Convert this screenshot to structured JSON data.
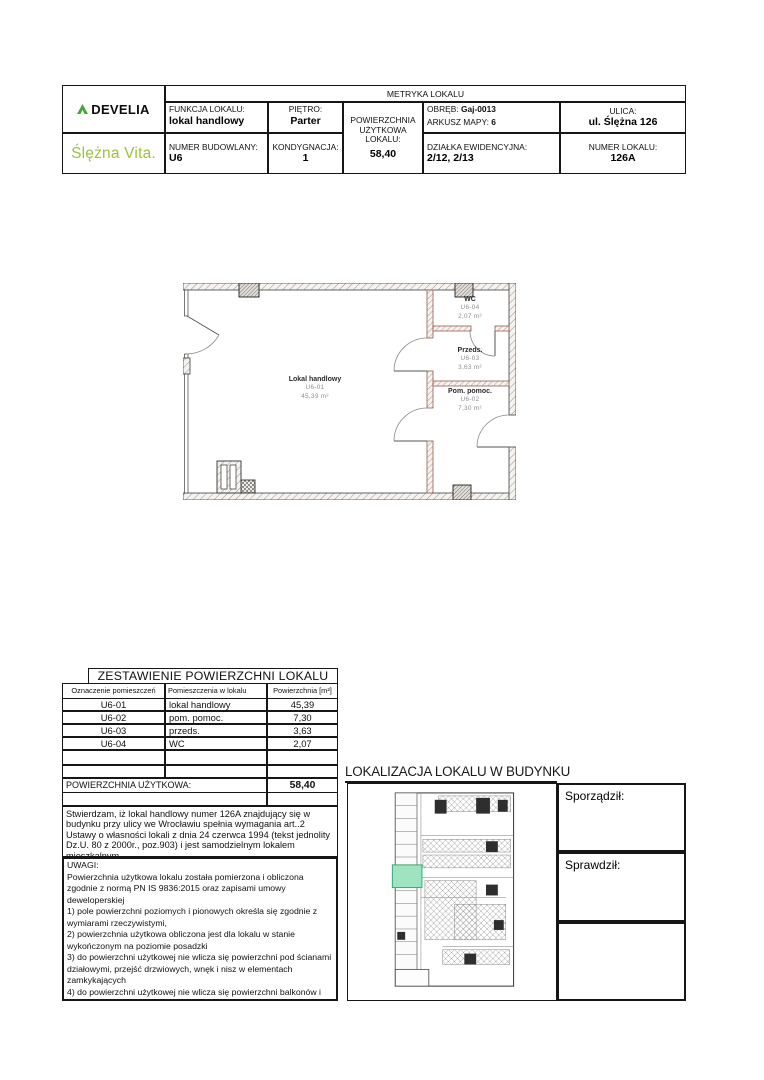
{
  "header": {
    "title": "METRYKA LOKALU",
    "brand_top": "DEVELIA",
    "brand_bottom": "Ślężna Vita.",
    "brand_green": "#9cc23c",
    "funkcja_label": "FUNKCJA LOKALU:",
    "funkcja_value": "lokal handlowy",
    "pietro_label": "PIĘTRO:",
    "pietro_value": "Parter",
    "powierzchnia_label": "POWIERZCHNIA UŻYTKOWA LOKALU:",
    "powierzchnia_value": "58,40",
    "obreb_label": "OBRĘB:",
    "obreb_value": "Gaj-0013",
    "arkusz_label": "ARKUSZ MAPY:",
    "arkusz_value": "6",
    "ulica_label": "ULICA:",
    "ulica_value": "ul. Ślężna 126",
    "numer_budowlany_label": "NUMER BUDOWLANY:",
    "numer_budowlany_value": "U6",
    "kondygnacja_label": "KONDYGNACJA:",
    "kondygnacja_value": "1",
    "dzialka_label": "DZIAŁKA EWIDENCYJNA:",
    "dzialka_value": "2/12, 2/13",
    "numer_lokalu_label": "NUMER LOKALU:",
    "numer_lokalu_value": "126A"
  },
  "floor_plan": {
    "rooms": [
      {
        "name": "Lokal handlowy",
        "code": "U6-01",
        "area": "45,39 m²"
      },
      {
        "name": "WC",
        "code": "U6-04",
        "area": "2,07 m²"
      },
      {
        "name": "Przeds.",
        "code": "U6-03",
        "area": "3,63 m²"
      },
      {
        "name": "Pom. pomoc.",
        "code": "U6-02",
        "area": "7,30 m²"
      }
    ]
  },
  "area_table": {
    "title": "ZESTAWIENIE POWIERZCHNI LOKALU",
    "headers": [
      "Oznaczenie pomieszczeń",
      "Pomieszczenia w lokalu",
      "Powierzchnia [m²]"
    ],
    "rows": [
      [
        "U6-01",
        "lokal handlowy",
        "45,39"
      ],
      [
        "U6-02",
        "pom. pomoc.",
        "7,30"
      ],
      [
        "U6-03",
        "przeds.",
        "3,63"
      ],
      [
        "U6-04",
        "WC",
        "2,07"
      ]
    ],
    "total_label": "POWIERZCHNIA UŻYTKOWA:",
    "total_value": "58,40"
  },
  "statement": "Stwierdzam, iż lokal handlowy numer 126A znajdujący się w budynku przy ulicy we Wrocławiu spełnia wymagania art..2 Ustawy o własności lokali z dnia 24 czerwca 1994 (tekst jednolity Dz.U. 80 z 2000r., poz.903) i jest samodzielnym lokalem mieszkalnym.",
  "uwagi": {
    "title": "UWAGI:",
    "lines": [
      "Powierzchnia użytkowa lokalu została pomierzona i obliczona zgodnie z normą PN IS 9836:2015 oraz zapisami umowy deweloperskiej",
      "1) pole powierzchni poziomych i pionowych określa się zgodnie z wymiarami rzeczywistymi,",
      "2) powierzchnia użytkowa obliczona jest dla lokalu w stanie wykończonym na poziomie posadzki",
      "3) do powierzchni użytkowej nie wlicza się powierzchni pod ścianami działowymi, przejść drzwiowych, wnęk i nisz w elementach zamkykających",
      "4) do powierzchni użytkowej nie wlicza się powierzchni balkonów i tarasów",
      "Powierzchnia lokalu oraz układ ścian działowych odpowiada stanowi faktycznemu na dzień pomiaru - 20.09.2024r."
    ]
  },
  "localization": {
    "title": "LOKALIZACJA LOKALU W BUDYNKU",
    "sporzadzil_label": "Sporządził:",
    "sprawdzil_label": "Sprawdził:",
    "highlight_color": "#9fe3c1"
  }
}
